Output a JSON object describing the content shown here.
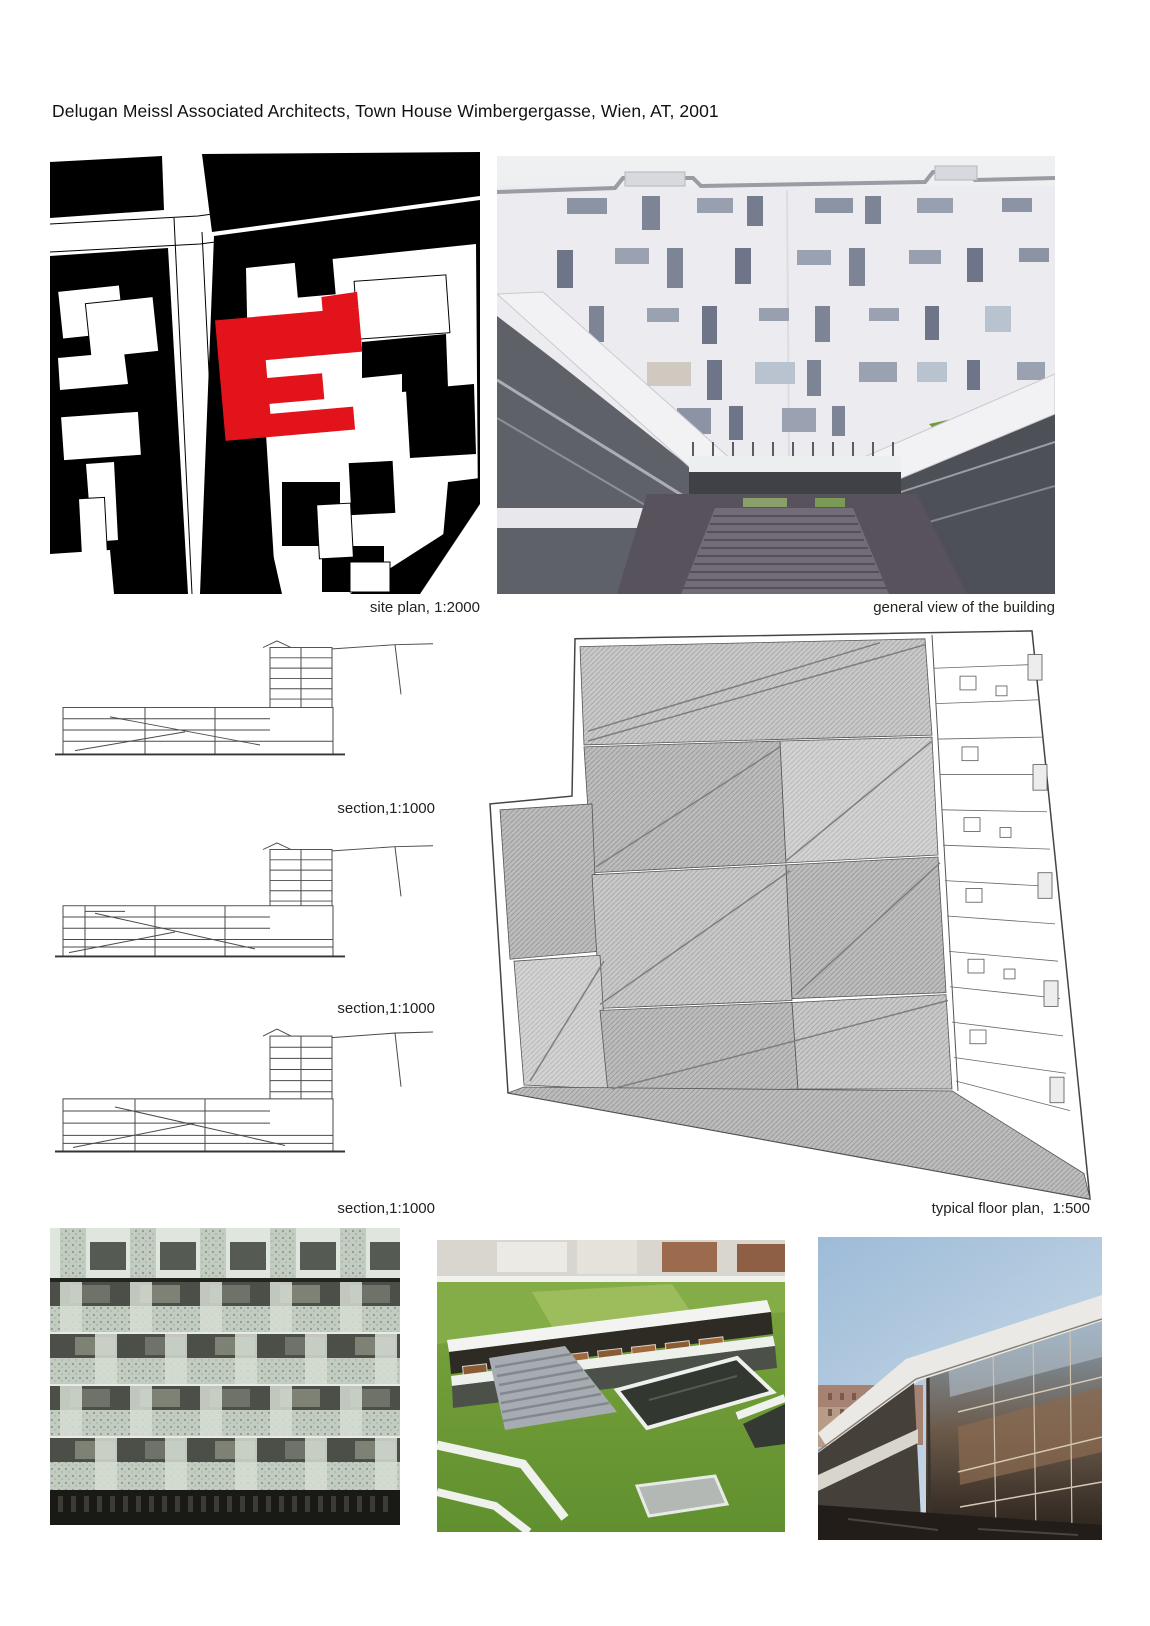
{
  "page": {
    "title": "Delugan Meissl Associated Architects, Town House Wimbergergasse, Wien, AT, 2001"
  },
  "figures": {
    "site_plan": {
      "caption": "site plan, 1:2000"
    },
    "general_view": {
      "caption": "general view of the building"
    },
    "sections": [
      {
        "caption": "section,1:1000"
      },
      {
        "caption": "section,1:1000"
      },
      {
        "caption": "section,1:1000"
      }
    ],
    "floor_plan": {
      "caption": "typical floor plan,  1:500"
    }
  },
  "colors": {
    "highlight_red": "#e2131b",
    "grass_green": "#75a23b",
    "paper_white": "#ffffff"
  }
}
